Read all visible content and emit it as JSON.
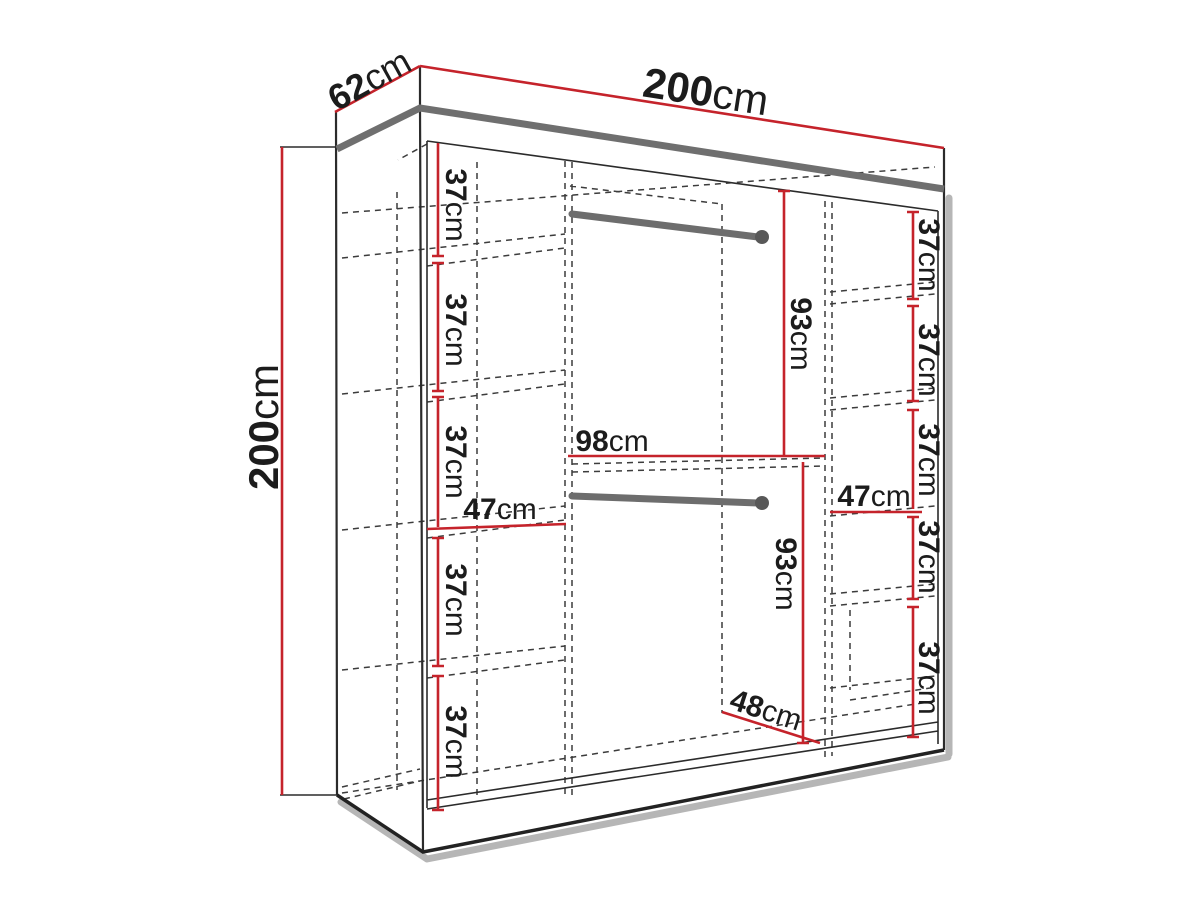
{
  "diagram": {
    "title": "wardrobe-dimension-drawing",
    "wardrobe_overall_cm": {
      "width": 200,
      "depth": 62,
      "height": 200
    },
    "sections": {
      "left_column": {
        "inner_width_cm": 47,
        "shelf_gap_heights_cm": [
          37,
          37,
          37,
          37,
          37
        ]
      },
      "middle_column": {
        "inner_width_cm": 98,
        "hanging_space_heights_cm": [
          93,
          93
        ],
        "hanging_rails": 2,
        "bottom_diagonal_cm": 48
      },
      "right_column": {
        "inner_width_cm": 47,
        "shelf_gap_heights_cm": [
          37,
          37,
          37,
          37,
          37
        ]
      }
    },
    "colors": {
      "dimension_red": "#c5232b",
      "line_black": "#2b2b2b",
      "hidden_dash_gray": "#3c3c3c",
      "shadow_gray": "#a9a9a9",
      "top_band_gray": "#6f6f6f",
      "rail_gray": "#6d6d6d"
    }
  },
  "labels": {
    "depth": {
      "value": "62",
      "unit": "cm"
    },
    "width_top": {
      "value": "200",
      "unit": "cm"
    },
    "height_left": {
      "value": "200",
      "unit": "cm"
    },
    "shelf": {
      "value": "37",
      "unit": "cm"
    },
    "col_width_left": {
      "value": "47",
      "unit": "cm"
    },
    "col_width_right": {
      "value": "47",
      "unit": "cm"
    },
    "mid_width": {
      "value": "98",
      "unit": "cm"
    },
    "hang_height": {
      "value": "93",
      "unit": "cm"
    },
    "bottom_width": {
      "value": "48",
      "unit": "cm"
    }
  }
}
